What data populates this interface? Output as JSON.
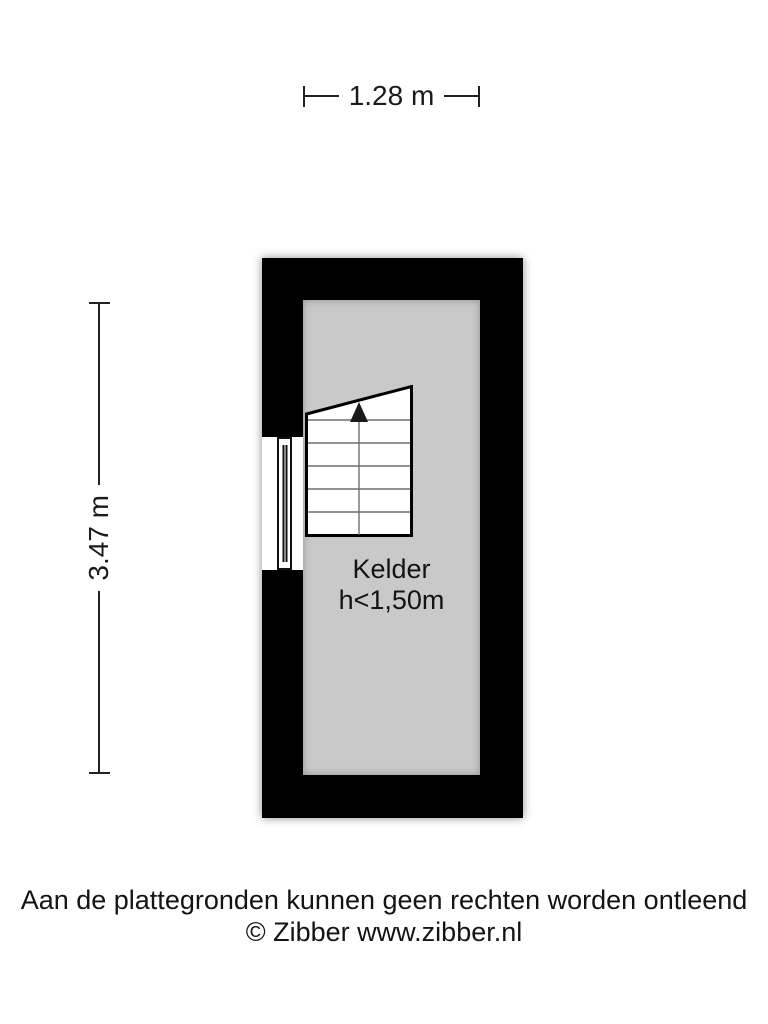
{
  "dimensions": {
    "width_label": "1.28 m",
    "height_label": "3.47 m"
  },
  "room": {
    "name": "Kelder",
    "height_note": "h<1,50m"
  },
  "footer": {
    "disclaimer": "Aan de plattegronden kunnen geen rechten worden ontleend",
    "credit": "© Zibber www.zibber.nl"
  },
  "colors": {
    "wall": "#000000",
    "floor": "#c9c9c9",
    "dimension_line": "#222222",
    "step_line": "#6e6e6e",
    "text": "#1a1a1a",
    "background": "#ffffff"
  },
  "icons": {
    "stairs_arrow": "up-arrow"
  }
}
